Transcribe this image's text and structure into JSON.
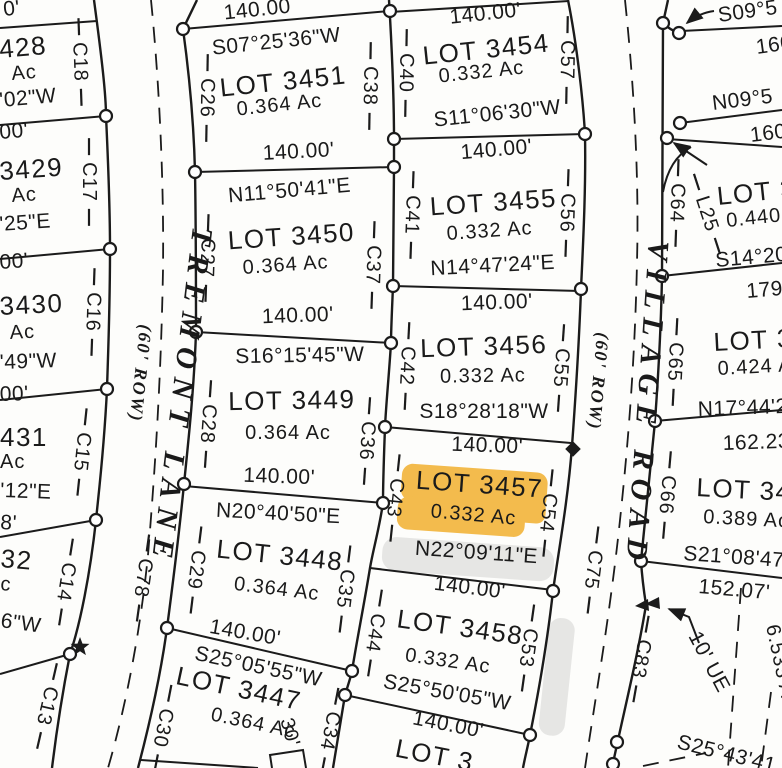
{
  "highlight": {
    "color": "#f2b336",
    "highlighted_lot": "LOT 3457"
  },
  "streets": {
    "tremont": {
      "name": "TREMONT LANE",
      "row": "(60' ROW)",
      "centerline_curve": "C78"
    },
    "village": {
      "name": "VILLAGE ROAD",
      "row": "(60' ROW)",
      "centerline_curve": "C75"
    }
  },
  "left_column": {
    "labels": [
      "0'",
      "428",
      "Ac",
      "'02\"W",
      "00'",
      "3429",
      "Ac",
      "'25\"E",
      "00'",
      "3430",
      "Ac",
      "'49\"W",
      "00'",
      "431",
      "Ac",
      "'12\"E",
      "8'",
      "32",
      "c",
      "6\"W"
    ],
    "curves": [
      "C18",
      "C17",
      "C16",
      "C15",
      "C14",
      "C13"
    ]
  },
  "column_a": {
    "top_distance": "140.00",
    "lots": [
      {
        "bearing": "S07°25'36\"W",
        "name": "LOT 3451",
        "area": "0.364 Ac",
        "distance": "140.00'"
      },
      {
        "bearing": "N11°50'41\"E",
        "name": "LOT 3450",
        "area": "0.364 Ac",
        "distance": "140.00'"
      },
      {
        "bearing": "S16°15'45\"W",
        "name": "LOT 3449",
        "area": "0.364 Ac",
        "distance": "140.00'"
      },
      {
        "bearing": "N20°40'50\"E",
        "name": "LOT 3448",
        "area": "0.364 Ac",
        "distance": "140.00'"
      },
      {
        "bearing": "S25°05'55\"W",
        "name": "LOT 3447",
        "area": "0.364 Ac"
      }
    ],
    "curves_west": [
      "C26",
      "C27",
      "C28",
      "C29",
      "C30"
    ],
    "curves_east": [
      "C38",
      "C37",
      "C36",
      "C35",
      "C34"
    ],
    "extra_label": "30'"
  },
  "column_b": {
    "top_distance": "140.00'",
    "lots": [
      {
        "name": "LOT 3454",
        "area": "0.332 Ac",
        "bearing": "S11°06'30\"W",
        "distance": "140.00'"
      },
      {
        "name": "LOT 3455",
        "area": "0.332 Ac",
        "bearing": "N14°47'24\"E",
        "distance": "140.00'"
      },
      {
        "name": "LOT 3456",
        "area": "0.332 Ac",
        "bearing": "S18°28'18\"W",
        "distance": "140.00'"
      },
      {
        "name": "LOT 3457",
        "area": "0.332 Ac",
        "bearing": "N22°09'11\"E",
        "distance": "140.00'"
      },
      {
        "name": "LOT 3458",
        "area": "0.332 Ac",
        "bearing": "S25°50'05\"W",
        "distance": "140.00'"
      }
    ],
    "bottom_partial_lot": "LOT 3",
    "curves_west": [
      "C40",
      "C41",
      "C42",
      "C43",
      "C44"
    ],
    "curves_east": [
      "C57",
      "C56",
      "C55",
      "C54",
      "C53"
    ]
  },
  "right_column": {
    "top": {
      "bearing": "S09°5",
      "distance": "160"
    },
    "second": {
      "bearing": "N09°5",
      "distance": "160"
    },
    "lots": [
      {
        "name": "LOT 3",
        "area": "0.440",
        "bearing": "S14°20",
        "distance": "179"
      },
      {
        "name": "LOT 34",
        "area": "0.424 A",
        "bearing": "N17°44'2",
        "distance": "162.23"
      },
      {
        "name": "LOT 347",
        "area": "0.389 Ac",
        "bearing": "S21°08'47",
        "distance": "152.07'"
      }
    ],
    "curves": [
      "C64",
      "C65",
      "C66",
      "C83"
    ],
    "chord_label": "L25",
    "easement_label": "10' UE",
    "area_partial": "6.533 A",
    "bottom_bearing_partial": "S25°43'41"
  }
}
